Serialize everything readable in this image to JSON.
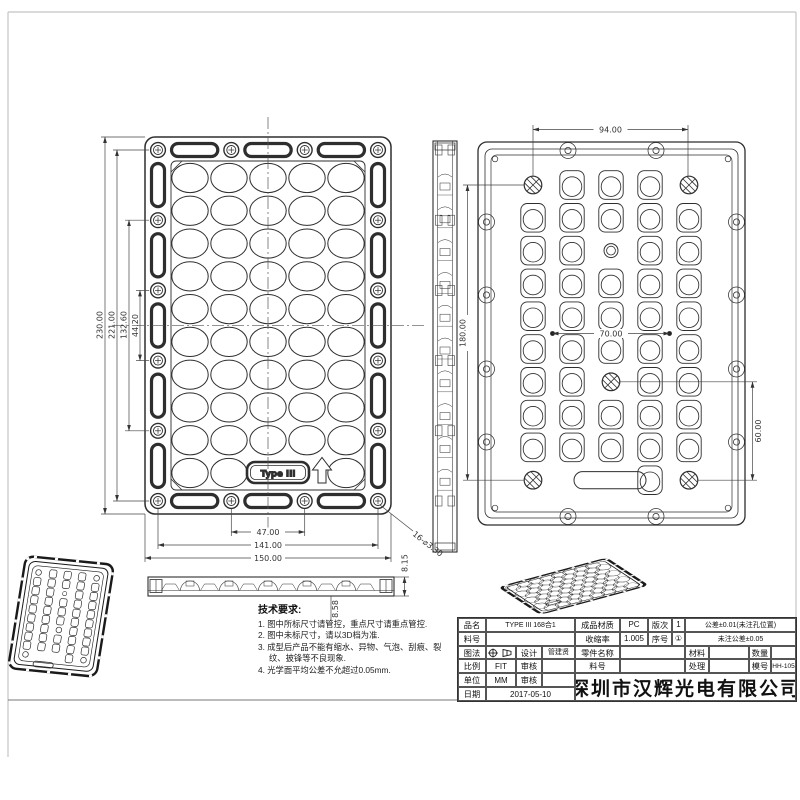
{
  "front_view": {
    "type_label": "Type III",
    "dim_height": "230.00",
    "dim_hole_span_v": "221.00",
    "dim_hole_span_132": "132.60",
    "dim_hole_gap": "44.20",
    "dim_slot_span": "47.00",
    "dim_hole_span_h": "141.00",
    "dim_width": "150.00",
    "holes_callout": "16-⌀3.30"
  },
  "back_view": {
    "dim_top_holes": "94.00",
    "dim_height_holes": "180.00",
    "dim_center_span": "70.00",
    "dim_lower_span": "60.00"
  },
  "side_view": {
    "dim_thickness": "8.15",
    "dim_total_height": "8.58"
  },
  "tech_requirements": {
    "title": "技术要求:",
    "items": [
      "1. 图中所标尺寸请管控，重点尺寸请重点管控.",
      "2. 图中未标尺寸，请以3D档为准.",
      "3. 成型后产品不能有缩水、异物、气泡、刮痕、裂纹、披锋等不良现象.",
      "4. 光学面平均公差不允超过0.05mm."
    ]
  },
  "title_block": {
    "labels": {
      "product": "品名",
      "part_no": "料号",
      "projection": "图法",
      "scale": "比例",
      "unit": "单位",
      "date": "日期",
      "design": "设计",
      "check": "审核",
      "check2": "审核",
      "material_finished": "成品材质",
      "shrinkage": "收缩率",
      "part_name": "零件名称",
      "part_no2": "料号",
      "revision": "版次",
      "serial": "序号",
      "material": "材料",
      "quantity": "数量",
      "treatment": "处理",
      "mold_no": "模号"
    },
    "values": {
      "product": "TYPE III 168合1",
      "scale": "FIT",
      "unit": "MM",
      "date": "2017-05-10",
      "designer": "管建贤",
      "material_finished": "PC",
      "shrinkage": "1.005",
      "revision": "1",
      "serial": "①",
      "mold_no": "HH-105"
    },
    "tolerance_line1": "公差±0.01(未注孔位置)",
    "tolerance_line2": "未注公差±0.05",
    "company": "深圳市汉辉光电有限公司"
  }
}
